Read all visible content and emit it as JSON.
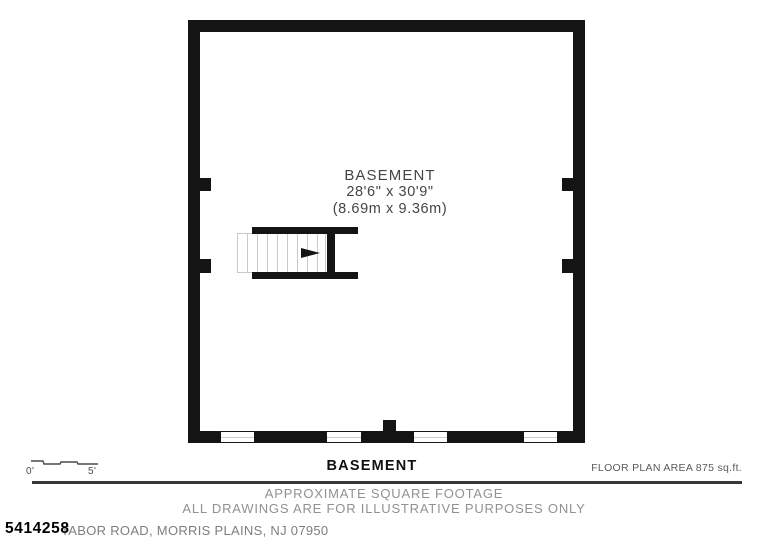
{
  "plan": {
    "room": {
      "name": "BASEMENT",
      "dimensions_ft": "28'6\" x 30'9\"",
      "dimensions_m": "(8.69m x 9.36m)"
    }
  },
  "scale": {
    "start_label": "0'",
    "end_label": "5'"
  },
  "footer": {
    "floor_title": "BASEMENT",
    "area_label": "FLOOR PLAN AREA 875 sq.ft.",
    "disclaimer_line1": "APPROXIMATE SQUARE FOOTAGE",
    "disclaimer_line2": "ALL DRAWINGS ARE FOR ILLUSTRATIVE PURPOSES ONLY",
    "listing_id": "5414258",
    "address": "TABOR ROAD, MORRIS PLAINS, NJ 07950"
  },
  "colors": {
    "wall": "#141414",
    "tread_line": "#c9c9c9",
    "gray_text": "#919191",
    "divider": "#383838"
  }
}
